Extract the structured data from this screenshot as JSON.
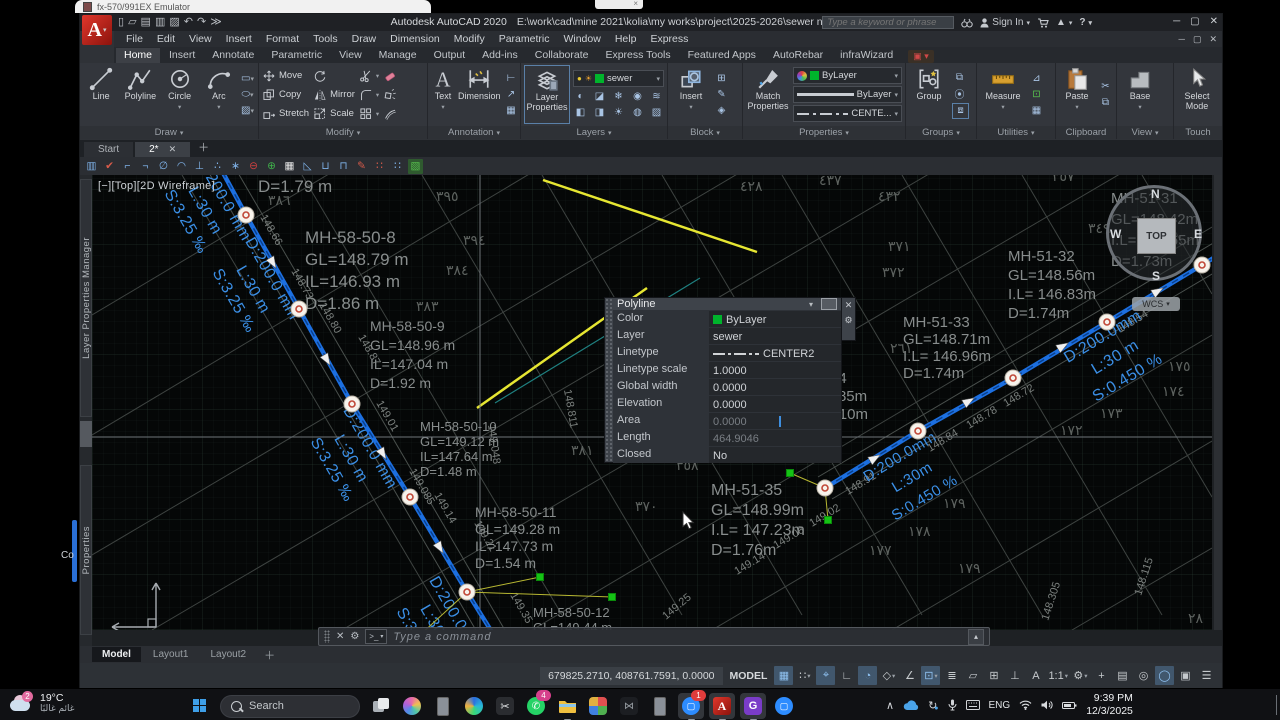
{
  "desktop": {
    "emulator_window_title": "fx-570/991EX Emulator",
    "fragment_text": "Co"
  },
  "titlebar": {
    "app": "Autodesk AutoCAD 2020",
    "path": "E:\\work\\cad\\mine 2021\\kolia\\my works\\project\\2025-2026\\sewer network\\01-...\\2.dwg",
    "search_placeholder": "Type a keyword or phrase",
    "sign_in": "Sign In",
    "qat": [
      "new",
      "open",
      "save",
      "save-as",
      "plot",
      "undo",
      "redo",
      "more"
    ]
  },
  "menubar": {
    "items": [
      "File",
      "Edit",
      "View",
      "Insert",
      "Format",
      "Tools",
      "Draw",
      "Dimension",
      "Modify",
      "Parametric",
      "Window",
      "Help",
      "Express"
    ]
  },
  "ribbon_tabs": [
    {
      "label": "Home",
      "active": true
    },
    {
      "label": "Insert"
    },
    {
      "label": "Annotate"
    },
    {
      "label": "Parametric"
    },
    {
      "label": "View"
    },
    {
      "label": "Manage"
    },
    {
      "label": "Output"
    },
    {
      "label": "Add-ins"
    },
    {
      "label": "Collaborate"
    },
    {
      "label": "Express Tools"
    },
    {
      "label": "Featured Apps"
    },
    {
      "label": "AutoRebar"
    },
    {
      "label": "infraWizard"
    }
  ],
  "ribbon": {
    "draw": {
      "title": "Draw",
      "line": "Line",
      "polyline": "Polyline",
      "circle": "Circle",
      "arc": "Arc"
    },
    "modify": {
      "title": "Modify",
      "move": "Move",
      "copy": "Copy",
      "stretch": "Stretch",
      "mirror": "Mirror",
      "scale": "Scale"
    },
    "annotation": {
      "title": "Annotation",
      "text": "Text",
      "dimension": "Dimension"
    },
    "layers": {
      "title": "Layers",
      "button": "Layer Properties",
      "layer": "sewer",
      "layer_swatch": "#00b42c"
    },
    "block": {
      "title": "Block",
      "insert": "Insert"
    },
    "properties": {
      "title": "Properties",
      "match": "Match Properties",
      "color": "ByLayer",
      "color_swatch": "#00b42c",
      "lineweight": "ByLayer",
      "linetype": "CENTE..."
    },
    "groups": {
      "title": "Groups",
      "group": "Group"
    },
    "utilities": {
      "title": "Utilities",
      "measure": "Measure"
    },
    "clipboard": {
      "title": "Clipboard",
      "paste": "Paste"
    },
    "view": {
      "title": "View",
      "base": "Base"
    },
    "touch": {
      "title": "Touch",
      "select": "Select Mode"
    }
  },
  "file_tabs": [
    {
      "label": "Start",
      "active": false
    },
    {
      "label": "2*",
      "active": true
    }
  ],
  "qtoolbar": {
    "icons": [
      {
        "g": "▥",
        "c": "#7fb2e8"
      },
      {
        "g": "✔",
        "c": "#d85b4a"
      },
      {
        "g": "⌐",
        "c": "#7fb2e8"
      },
      {
        "g": "¬",
        "c": "#7fb2e8"
      },
      {
        "g": "∅",
        "c": "#7fb2e8"
      },
      {
        "g": "◠",
        "c": "#7fb2e8"
      },
      {
        "g": "⊥",
        "c": "#7fb2e8"
      },
      {
        "g": "∴",
        "c": "#7fb2e8"
      },
      {
        "g": "∗",
        "c": "#7fb2e8"
      },
      {
        "g": "⊖",
        "c": "#d04040"
      },
      {
        "g": "⊕",
        "c": "#3fae4a"
      },
      {
        "g": "▦",
        "c": "#e8e8e8"
      },
      {
        "g": "◺",
        "c": "#7fb2e8"
      },
      {
        "g": "⊔",
        "c": "#7fb2e8"
      },
      {
        "g": "⊓",
        "c": "#7fb2e8"
      },
      {
        "g": "✎",
        "c": "#d85b4a"
      },
      {
        "g": "∷",
        "c": "#d85b4a"
      },
      {
        "g": "∷",
        "c": "#7fb2e8"
      },
      {
        "g": "▧",
        "c": "#57c14e",
        "bg": "#2f5a2f"
      }
    ]
  },
  "palettes": {
    "tab1": "Layer Properties Manager",
    "tab2": "Properties"
  },
  "viewport": {
    "menu": "[−]",
    "view": "[Top]",
    "visual": "[2D Wireframe]"
  },
  "viewcube": {
    "n": "N",
    "s": "S",
    "e": "E",
    "w": "W",
    "top": "TOP",
    "wcs": "WCS"
  },
  "quick_properties": {
    "title": "Polyline",
    "rows": [
      {
        "label": "Color",
        "value": "ByLayer",
        "swatch": "#00b42c"
      },
      {
        "label": "Layer",
        "value": "sewer"
      },
      {
        "label": "Linetype",
        "value": "CENTER2",
        "glyph": true
      },
      {
        "label": "Linetype scale",
        "value": "1.0000"
      },
      {
        "label": "Global width",
        "value": "0.0000"
      },
      {
        "label": "Elevation",
        "value": "0.0000"
      },
      {
        "label": "Area",
        "value": "0.0000",
        "dim": true,
        "caret": true
      },
      {
        "label": "Length",
        "value": "464.9046",
        "dim": true
      },
      {
        "label": "Closed",
        "value": "No"
      }
    ]
  },
  "command_line": {
    "prompt": "Type a command"
  },
  "layout_tabs": {
    "items": [
      {
        "label": "Model",
        "active": true
      },
      {
        "label": "Layout1"
      },
      {
        "label": "Layout2"
      }
    ]
  },
  "status_bar": {
    "coords": "679825.2710, 408761.7591, 0.0000",
    "space": "MODEL",
    "icons": [
      {
        "name": "grid-display",
        "g": "▦",
        "a": true
      },
      {
        "name": "snap-mode",
        "g": "∷",
        "c": true
      },
      {
        "name": "dynamic-input",
        "g": "⌖",
        "a": true
      },
      {
        "name": "ortho-mode",
        "g": "∟"
      },
      {
        "name": "polar-tracking",
        "g": "◔",
        "a": true
      },
      {
        "name": "isodraft",
        "g": "◇",
        "c": true
      },
      {
        "name": "osnap-tracking",
        "g": "∠"
      },
      {
        "name": "object-snap",
        "g": "⊡",
        "a": true,
        "c": true
      },
      {
        "name": "lineweight",
        "g": "≣"
      },
      {
        "name": "transparency",
        "g": "▱"
      },
      {
        "name": "selection-cycling",
        "g": "⊞"
      },
      {
        "name": "3d-osnap",
        "g": "⊥"
      },
      {
        "name": "annotation-visibility",
        "g": "A"
      },
      {
        "name": "annotation-scale",
        "g": "1:1",
        "c": true
      },
      {
        "name": "workspace-gear",
        "g": "⚙",
        "c": true
      },
      {
        "name": "annotation-add",
        "g": "+"
      },
      {
        "name": "units",
        "g": "▤"
      },
      {
        "name": "isolate-objects",
        "g": "◎"
      },
      {
        "name": "graphics-performance",
        "g": "◯",
        "a": true
      },
      {
        "name": "clean-screen",
        "g": "▣"
      },
      {
        "name": "customization-menu",
        "g": "☰"
      }
    ]
  },
  "taskbar": {
    "weather": {
      "badge": "2",
      "temp": "19°C",
      "desc": "غائم غالبًا"
    },
    "search_label": "Search",
    "apps": [
      {
        "name": "task-view"
      },
      {
        "name": "copilot"
      },
      {
        "name": "phone-link"
      },
      {
        "name": "browser"
      },
      {
        "name": "snipping-tool"
      },
      {
        "name": "whatsapp",
        "badge": "4",
        "badge_color": "#d6408c"
      },
      {
        "name": "file-explorer",
        "running": true
      },
      {
        "name": "photos"
      },
      {
        "name": "dark-app"
      },
      {
        "name": "device"
      },
      {
        "name": "zoom",
        "badge": "1",
        "badge_color": "#e03c3c",
        "running": true,
        "focus": true
      },
      {
        "name": "autocad",
        "running": true,
        "focus": true
      },
      {
        "name": "gpdf",
        "running": true,
        "focus": true
      },
      {
        "name": "zoom-meeting"
      }
    ],
    "tray": {
      "lang": "ENG",
      "time": "9:39 PM",
      "date": "12/3/2025"
    }
  },
  "canvas": {
    "colors": {
      "pipe": "#1c6fe0",
      "pipe_core": "#0a3f8a",
      "pipe_label": "#3b8fe6",
      "parcel": "#3e4341",
      "street": "#4a504d",
      "mh_text": "#888d8d",
      "elev_text": "#7b807e",
      "arabic": "#5d625f",
      "yellow": "#e6e632",
      "teal": "#1f8080",
      "leader": "#b8b832",
      "grip_green": "#15c215",
      "crosshair": "#6e747a"
    },
    "pipelines": [
      {
        "points": [
          [
            124,
            -15
          ],
          [
            154,
            40
          ],
          [
            207,
            134
          ],
          [
            260,
            229
          ],
          [
            318,
            322
          ],
          [
            375,
            417
          ],
          [
            403,
            462
          ]
        ]
      },
      {
        "points": [
          [
            733,
            313
          ],
          [
            826,
            256
          ],
          [
            921,
            203
          ],
          [
            1015,
            147
          ],
          [
            1110,
            90
          ],
          [
            1128,
            79
          ]
        ]
      }
    ],
    "grips": [
      [
        154,
        40
      ],
      [
        207,
        134
      ],
      [
        260,
        229
      ],
      [
        318,
        322
      ],
      [
        375,
        417
      ],
      [
        733,
        313
      ],
      [
        826,
        256
      ],
      [
        921,
        203
      ],
      [
        1015,
        147
      ],
      [
        1110,
        90
      ]
    ],
    "arrows": [
      [
        178,
        83,
        59.6
      ],
      [
        232,
        180,
        59.6
      ],
      [
        288,
        274,
        59.6
      ],
      [
        345,
        368,
        59.6
      ],
      [
        778,
        286,
        -30.6
      ],
      [
        872,
        229,
        -30.6
      ],
      [
        966,
        174,
        -30.6
      ],
      [
        1061,
        119,
        -30.6
      ]
    ],
    "green_grips": [
      [
        698,
        298
      ],
      [
        736,
        345
      ],
      [
        448,
        402
      ],
      [
        520,
        422
      ],
      [
        328,
        460
      ]
    ],
    "leaders": [
      [
        733,
        313,
        698,
        298
      ],
      [
        733,
        313,
        736,
        345
      ],
      [
        375,
        417,
        448,
        402
      ],
      [
        375,
        417,
        520,
        422
      ],
      [
        375,
        417,
        328,
        460
      ]
    ],
    "yellow_lines": [
      [
        451,
        5,
        665,
        77
      ],
      [
        385,
        233,
        555,
        113
      ]
    ],
    "teal_lines": [
      [
        403,
        228,
        608,
        103
      ]
    ],
    "street_lines": [
      [
        113,
        -9,
        392,
        469
      ],
      [
        135,
        -21,
        414,
        457
      ],
      [
        740,
        324,
        1137,
        89
      ],
      [
        726,
        302,
        1123,
        67
      ]
    ],
    "parcel_lines": [
      [
        0,
        140,
        420,
        -110
      ],
      [
        0,
        260,
        620,
        -110
      ],
      [
        0,
        380,
        830,
        -110
      ],
      [
        60,
        455,
        980,
        -85
      ],
      [
        250,
        455,
        1120,
        -55
      ],
      [
        440,
        455,
        1120,
        52
      ],
      [
        620,
        455,
        1120,
        160
      ],
      [
        800,
        455,
        1120,
        266
      ],
      [
        980,
        455,
        1120,
        373
      ],
      [
        90,
        0,
        350,
        440
      ],
      [
        210,
        0,
        470,
        440
      ],
      [
        330,
        0,
        590,
        440
      ],
      [
        450,
        0,
        710,
        440
      ],
      [
        570,
        0,
        830,
        440
      ],
      [
        690,
        0,
        950,
        440
      ],
      [
        810,
        0,
        1070,
        440
      ],
      [
        930,
        0,
        1120,
        322
      ],
      [
        1050,
        0,
        1120,
        119
      ]
    ],
    "mh_labels": [
      {
        "x": 213,
        "y": 68,
        "lh": 22,
        "fs": 17,
        "lines": [
          "MH-58-50-8",
          "GL=148.79 m",
          "IL=146.93 m",
          "D=1.86 m"
        ]
      },
      {
        "x": 166,
        "y": 17,
        "lh": 22,
        "fs": 17,
        "lines": [
          "D=1.79 m"
        ]
      },
      {
        "x": 278,
        "y": 156,
        "lh": 19,
        "fs": 14,
        "lines": [
          "MH-58-50-9",
          "GL=148.96 m",
          "IL=147.04 m",
          "D=1.92 m"
        ]
      },
      {
        "x": 328,
        "y": 256,
        "lh": 15,
        "fs": 13,
        "lines": [
          "MH-58-50-10",
          "GL=149.12 m",
          "IL=147.64 m",
          "D=1.48 m"
        ]
      },
      {
        "x": 383,
        "y": 342,
        "lh": 17,
        "fs": 14,
        "lines": [
          "MH-58-50-11",
          "GL=149.28 m",
          "IL=147.73 m",
          "D=1.54 m"
        ]
      },
      {
        "x": 441,
        "y": 442,
        "lh": 15,
        "fs": 13,
        "lines": [
          "MH-58-50-12",
          "GL=149.44 m",
          "IL=147.84 m"
        ]
      },
      {
        "x": 1019,
        "y": 28,
        "lh": 21,
        "fs": 15,
        "lines": [
          "MH-51-31",
          "GL=148.42m",
          "I.L= 146.65m",
          "D=1.73m"
        ]
      },
      {
        "x": 916,
        "y": 86,
        "lh": 19,
        "fs": 15,
        "lines": [
          "MH-51-32",
          "GL=148.56m",
          "I.L= 146.83m",
          "D=1.74m"
        ]
      },
      {
        "x": 811,
        "y": 152,
        "lh": 17,
        "fs": 15,
        "lines": [
          "MH-51-33",
          "GL=148.71m",
          "I.L= 146.96m",
          "D=1.74m"
        ]
      },
      {
        "x": 688,
        "y": 208,
        "lh": 18,
        "fs": 15,
        "lines": [
          "MH-51-34",
          "GL=148.85m",
          "I.L= 147.10m",
          "D=1.75m"
        ]
      },
      {
        "x": 619,
        "y": 320,
        "lh": 20,
        "fs": 16,
        "lines": [
          "MH-51-35",
          "GL=148.99m",
          "I.L= 147.23m",
          "D=1.76m"
        ]
      }
    ],
    "pipe_label_clusters": [
      {
        "x": 140,
        "y": 20,
        "rot": 60,
        "fs": 16,
        "off": [
          14,
          36,
          58
        ],
        "lines": [
          "D:200.0 mm",
          "L:30 m",
          "S:3.25 ‰"
        ]
      },
      {
        "x": 188,
        "y": 99,
        "rot": 60,
        "fs": 16,
        "off": [
          14,
          36,
          58
        ],
        "lines": [
          "D:200.0 mm",
          "L:30 m",
          "S:3.25 ‰"
        ]
      },
      {
        "x": 286,
        "y": 268,
        "rot": 60,
        "fs": 16,
        "off": [
          14,
          36,
          58
        ],
        "lines": [
          "D:200.0 mm",
          "L:30 m",
          "S:3.25 ‰"
        ]
      },
      {
        "x": 372,
        "y": 438,
        "rot": 60,
        "fs": 16,
        "off": [
          14,
          36,
          58
        ],
        "lines": [
          "D:200.0 mm",
          "L:30 m",
          "S:3.25 ‰"
        ]
      },
      {
        "x": 1005,
        "y": 152,
        "rot": -31,
        "fs": 16,
        "off": [
          16,
          40,
          64
        ],
        "lines": [
          "D:200.0mm",
          "L:30 m",
          "S:0.450 %"
        ]
      },
      {
        "x": 802,
        "y": 272,
        "rot": -31,
        "fs": 15,
        "off": [
          16,
          40,
          64
        ],
        "lines": [
          "D:200.0mm",
          "L:30m",
          "S:0.450 %"
        ]
      }
    ],
    "elevations": [
      [
        "148.66",
        168,
        42,
        60
      ],
      [
        "148.73",
        199,
        96,
        60
      ],
      [
        "148.80",
        227,
        130,
        60
      ],
      [
        "148.87",
        266,
        162,
        60
      ],
      [
        "149.01",
        284,
        228,
        60
      ],
      [
        "149.048",
        396,
        250,
        82
      ],
      [
        "149.085",
        317,
        296,
        60
      ],
      [
        "149.14",
        342,
        320,
        60
      ],
      [
        "149.21",
        382,
        348,
        60
      ],
      [
        "149.35",
        418,
        420,
        60
      ],
      [
        "148.811",
        472,
        215,
        80
      ],
      [
        "148.54",
        1028,
        158,
        -31
      ],
      [
        "148.72",
        914,
        232,
        -31
      ],
      [
        "148.78",
        877,
        254,
        -31
      ],
      [
        "148.84",
        838,
        277,
        -31
      ],
      [
        "148.91",
        756,
        320,
        -31
      ],
      [
        "149.02",
        720,
        352,
        -31
      ],
      [
        "149.08",
        684,
        374,
        -31
      ],
      [
        "149.14",
        645,
        400,
        -31
      ],
      [
        "149.25",
        574,
        445,
        -40
      ],
      [
        "148.305",
        956,
        446,
        -72
      ],
      [
        "148.115",
        1049,
        421,
        -72
      ]
    ],
    "arabic_numbers": [
      [
        "٣٨٦",
        176,
        30
      ],
      [
        "٣٩٥",
        344,
        26
      ],
      [
        "٣٩٤",
        371,
        70
      ],
      [
        "٣٨٤",
        354,
        100
      ],
      [
        "٣٨٣",
        324,
        136
      ],
      [
        "٣٨١",
        479,
        280
      ],
      [
        "٣٧٠",
        543,
        336
      ],
      [
        "٣٥٨",
        584,
        295
      ],
      [
        "٣٧١",
        796,
        76
      ],
      [
        "٣٧٢",
        790,
        102
      ],
      [
        "٣٤٩",
        996,
        58
      ],
      [
        "٣٥٧",
        960,
        6
      ],
      [
        "١٧٥",
        1076,
        196
      ],
      [
        "١٧٤",
        1070,
        221
      ],
      [
        "١٧٣",
        1008,
        243
      ],
      [
        "١٧٢",
        968,
        260
      ],
      [
        "١٧٩",
        851,
        333
      ],
      [
        "١٧٨",
        816,
        361
      ],
      [
        "١٧٧",
        777,
        380
      ],
      [
        "١٧٩",
        866,
        398
      ],
      [
        "٤٢٨",
        648,
        16
      ],
      [
        "٤٣٧",
        727,
        10
      ],
      [
        "٤٣٢",
        786,
        26
      ],
      [
        "٢٦١",
        798,
        178
      ],
      [
        "٢٨",
        1096,
        448
      ]
    ],
    "crosshair": {
      "x": 388,
      "y": 262
    },
    "cursor": {
      "x": 591,
      "y": 337
    }
  }
}
